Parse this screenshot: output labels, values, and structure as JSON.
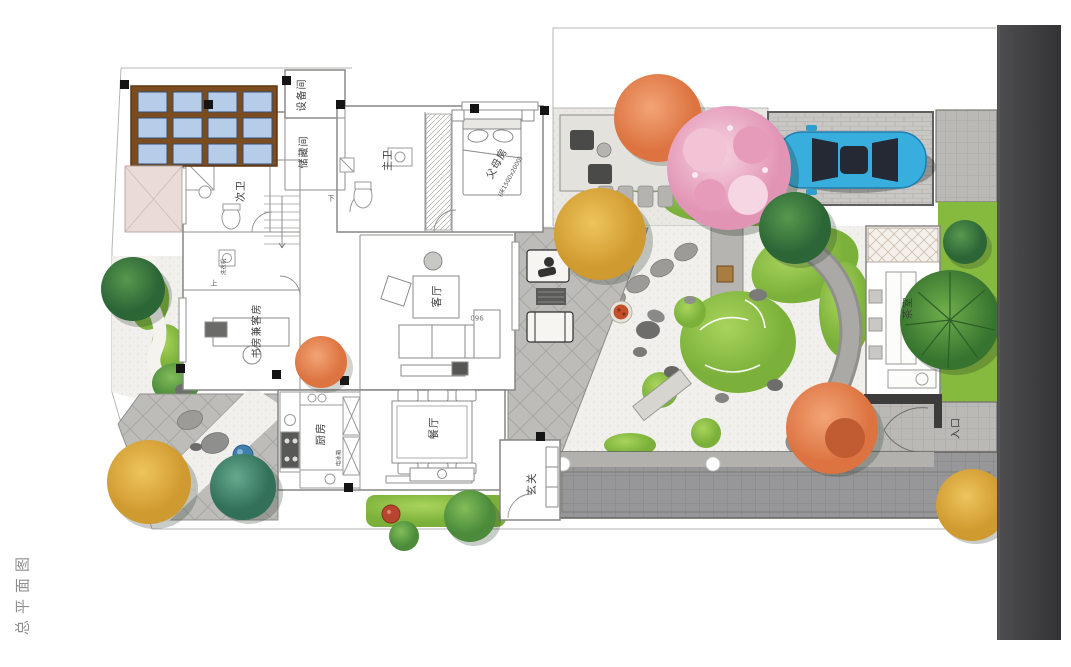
{
  "title": "总平面图",
  "labels": {
    "equipment_room": "设备间",
    "storage_room": "储藏间",
    "master_bath": "主卫",
    "second_bath": "次卫",
    "parents_room": "父母房",
    "parents_room_bed": "(床1500x2000)",
    "living_room": "客厅",
    "living_room_dim": "960",
    "study_guest_room": "书房兼客房",
    "kitchen": "厨房",
    "kitchen_cabinet": "电冰箱",
    "laundry": "洗衣机",
    "dining_room": "餐厅",
    "foyer": "玄关",
    "tea_room": "茶室",
    "entrance": "入口",
    "stair_up": "上",
    "stair_down": "下"
  },
  "colors": {
    "car_blue": "#38aede",
    "lawn_green": "#86ba3e",
    "cherry_pink": "#e9a8c2",
    "maple_orange": "#dd7440",
    "skylight_frame": "#7c4b1e",
    "skylight_glass": "#b6cde9",
    "dark_strip": "#424244",
    "firepit": "#c1502b",
    "water_blue": "#3f7fae"
  }
}
